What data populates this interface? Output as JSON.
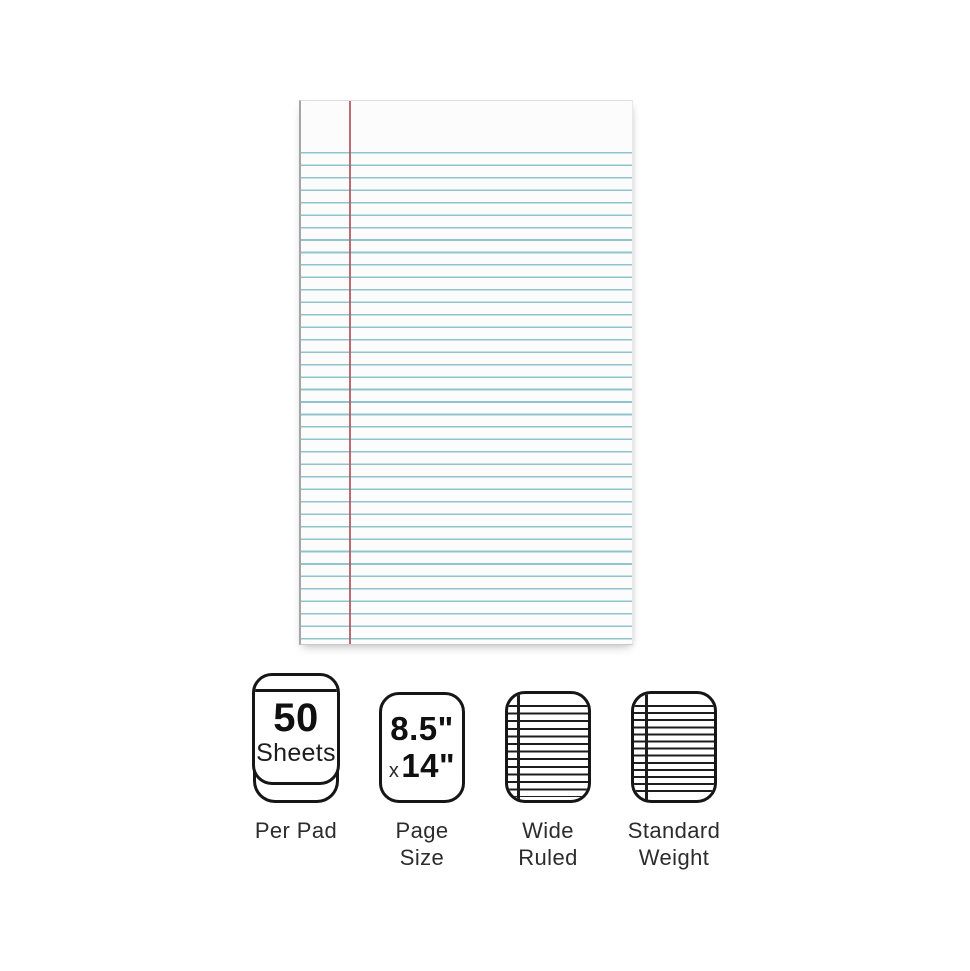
{
  "page": {
    "background_color": "#ffffff"
  },
  "paper_preview": {
    "kind": "legal-pad-ruled-sheet",
    "rule_line_color": "#8fc3cd",
    "margin_line_color": "#b2575f",
    "paper_color": "#fcfcfd",
    "rule_count": 40
  },
  "features": [
    {
      "icon": "pad-stack-icon",
      "value": "50",
      "unit": "Sheets",
      "label": "Per Pad"
    },
    {
      "icon": "page-size-icon",
      "width_value": "8.5\"",
      "times": "x",
      "height_value": "14\"",
      "label": "Page\nSize"
    },
    {
      "icon": "wide-ruled-paper-icon",
      "label": "Wide\nRuled"
    },
    {
      "icon": "standard-weight-paper-icon",
      "label": "Standard\nWeight"
    }
  ]
}
